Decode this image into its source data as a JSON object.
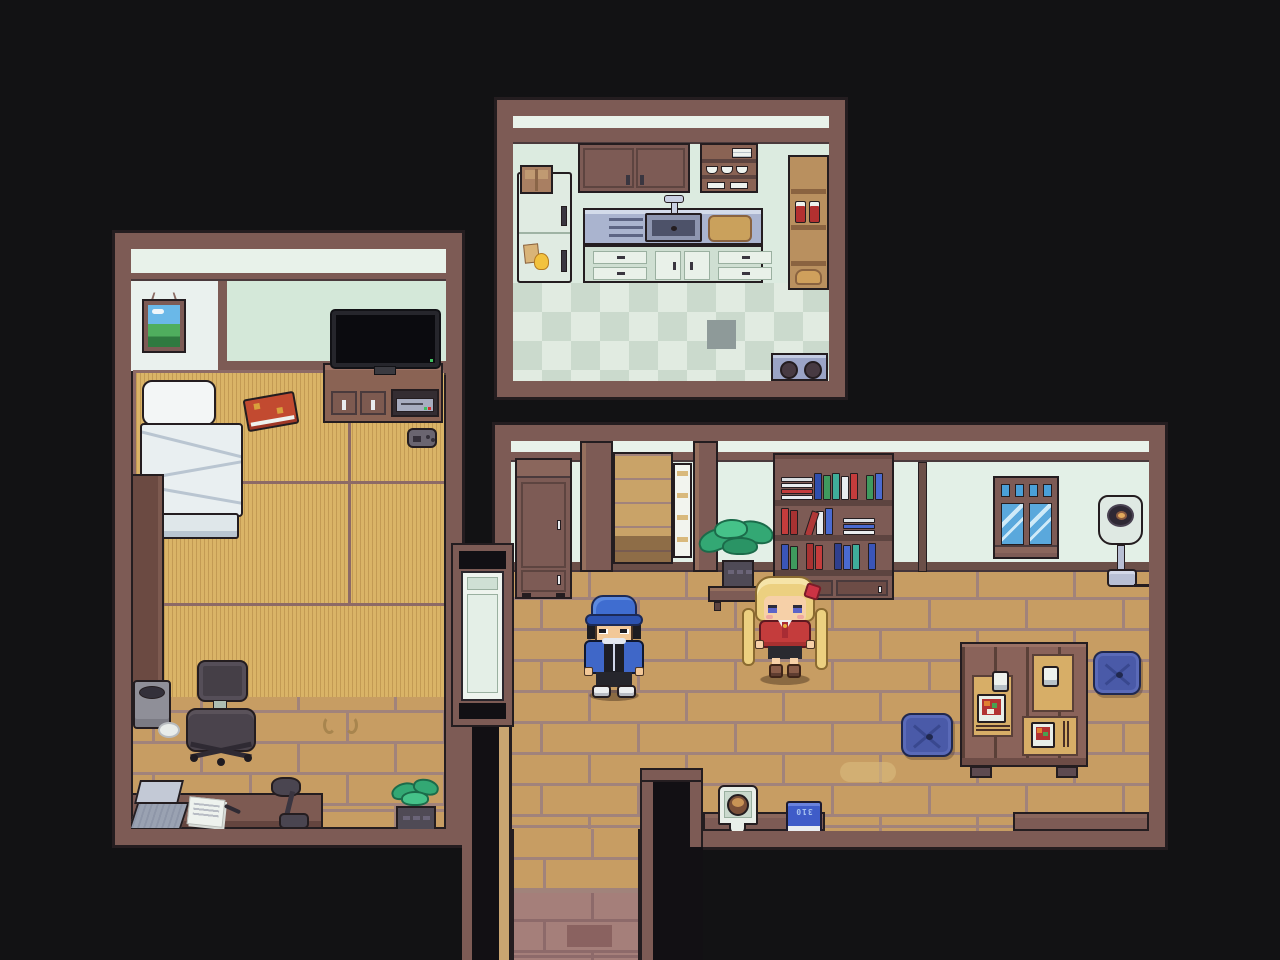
{
  "scene": {
    "type": "top-down pixel-art RPG house interior",
    "background": "#121214",
    "rooms_count": 3
  },
  "labels": {
    "floor_book": "310"
  },
  "palette": {
    "frame_wood": "#7d5b55",
    "outline": "#241d20",
    "inner_lip": "#c9a571",
    "wall_mint": "#e3f0e7",
    "kitchen_wall": "#dcebe0",
    "floor_tan": "#c79d63",
    "floor_grout": "#a1837b",
    "tatami": "#dab467",
    "corridor_floor": "#a57f7a",
    "counter_steel": "#aab4cf",
    "cushion_blue": "#4a5aa8",
    "accent_red": "#c43c3c",
    "cap_blue": "#3f6dd0",
    "hair_blonde": "#ecd080"
  },
  "rooms": {
    "kitchen": {
      "name": "Kitchen",
      "objects": [
        "wall cabinets",
        "dish shelf",
        "refrigerator",
        "cardboard box",
        "sticky notes",
        "counter",
        "drying rack",
        "sink",
        "faucet",
        "cutting board",
        "drawer cabinets",
        "pantry shelf",
        "preserve jars",
        "bread loaf",
        "stove burners",
        "checkered floor",
        "dark tile"
      ]
    },
    "bedroom": {
      "name": "Bedroom",
      "objects": [
        "landscape picture",
        "window",
        "bed",
        "pillow",
        "tatami mats",
        "red book",
        "tv",
        "tv stand",
        "game console",
        "game controller",
        "side panel",
        "trash bin",
        "paper ball",
        "desk chair",
        "floor stain",
        "desk",
        "laptop",
        "papers",
        "pen",
        "desk lamp",
        "potted plant"
      ]
    },
    "living_room": {
      "name": "Living room",
      "objects": [
        "storage cabinet",
        "alcove passage",
        "shelf ladder",
        "potted plant",
        "plant stand",
        "bookshelf",
        "window",
        "floor lamp",
        "low table",
        "placemats",
        "teacups",
        "bento boxes",
        "chopsticks",
        "floor cushions",
        "space heater",
        "blue book",
        "corridor",
        "connecting door"
      ]
    }
  },
  "characters": {
    "boy": {
      "name": "boy-npc",
      "desc": "blue cap, black hair, blue jacket with black panel, black shorts, white sneakers"
    },
    "girl": {
      "name": "girl-npc",
      "desc": "blonde twin tails, red hair ribbon, red jacket, white shirt with red tie, brown boots"
    }
  },
  "bookshelf": {
    "shelves": [
      [
        {
          "t": "stack",
          "cs": [
            "#e8ecee",
            "#c43c3c",
            "#e8ecee",
            "#d8dde0"
          ]
        },
        {
          "t": "v",
          "c": "#2f4fae",
          "h": 27
        },
        {
          "t": "v",
          "c": "#3f9a5e",
          "h": 25
        },
        {
          "t": "v",
          "c": "#3fae9a",
          "h": 27
        },
        {
          "t": "v",
          "c": "#e8ecee",
          "h": 24
        },
        {
          "t": "v",
          "c": "#c43c3c",
          "h": 27
        },
        {
          "t": "gap",
          "w": 6
        },
        {
          "t": "v",
          "c": "#3f9a5e",
          "h": 25
        },
        {
          "t": "v",
          "c": "#4a6ad0",
          "h": 27
        }
      ],
      [
        {
          "t": "v",
          "c": "#c43c3c",
          "h": 27
        },
        {
          "t": "v",
          "c": "#a83232",
          "h": 25
        },
        {
          "t": "lean",
          "c": "#b03838",
          "h": 26
        },
        {
          "t": "v",
          "c": "#e8ecee",
          "h": 24
        },
        {
          "t": "v",
          "c": "#4a6ad0",
          "h": 27
        },
        {
          "t": "gap",
          "w": 8
        },
        {
          "t": "stack",
          "cs": [
            "#e8ecee",
            "#4a6ad0",
            "#dde2e6"
          ]
        }
      ],
      [
        {
          "t": "v",
          "c": "#3a55b8",
          "h": 26
        },
        {
          "t": "v",
          "c": "#3f9a5e",
          "h": 24
        },
        {
          "t": "gap",
          "w": 6
        },
        {
          "t": "v",
          "c": "#a83232",
          "h": 27
        },
        {
          "t": "v",
          "c": "#c43c3c",
          "h": 25
        },
        {
          "t": "gap",
          "w": 9
        },
        {
          "t": "v",
          "c": "#2f3f8e",
          "h": 27
        },
        {
          "t": "v",
          "c": "#4a6ad0",
          "h": 25
        },
        {
          "t": "v",
          "c": "#3fae9a",
          "h": 26
        },
        {
          "t": "gap",
          "w": 6
        },
        {
          "t": "v",
          "c": "#3a55b8",
          "h": 27
        }
      ]
    ]
  }
}
